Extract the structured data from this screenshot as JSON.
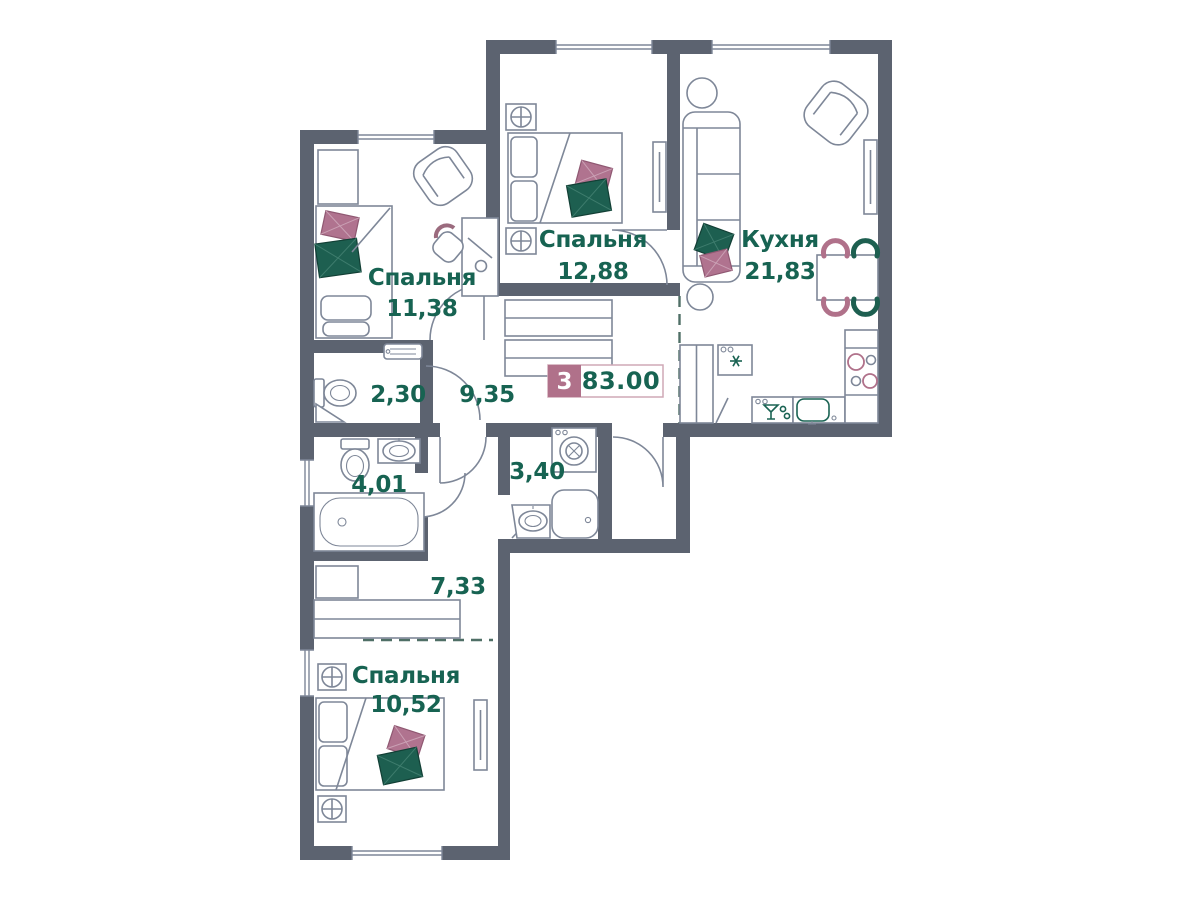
{
  "plan": {
    "badge": {
      "rooms_count": "3",
      "total_area": "83.00"
    },
    "rooms": {
      "bedroom1": {
        "name": "Спальня",
        "area": "11,38"
      },
      "bedroom2": {
        "name": "Спальня",
        "area": "12,88"
      },
      "kitchen": {
        "name": "Кухня",
        "area": "21,83"
      },
      "wc": {
        "area": "2,30"
      },
      "hallway": {
        "area": "9,35"
      },
      "bathroom": {
        "area": "4,01"
      },
      "laundry": {
        "area": "3,40"
      },
      "corridor": {
        "area": "7,33"
      },
      "bedroom3": {
        "name": "Спальня",
        "area": "10,52"
      }
    },
    "colors": {
      "wall": "#5c6370",
      "label_text": "#176352",
      "accent_pink": "#b0718a",
      "accent_green": "#1d5f50",
      "badge_background": "#b0718a",
      "badge_border": "#cfa8b6",
      "furniture_line": "#7e8798",
      "dashed_boundary": "#4f6f66"
    }
  }
}
